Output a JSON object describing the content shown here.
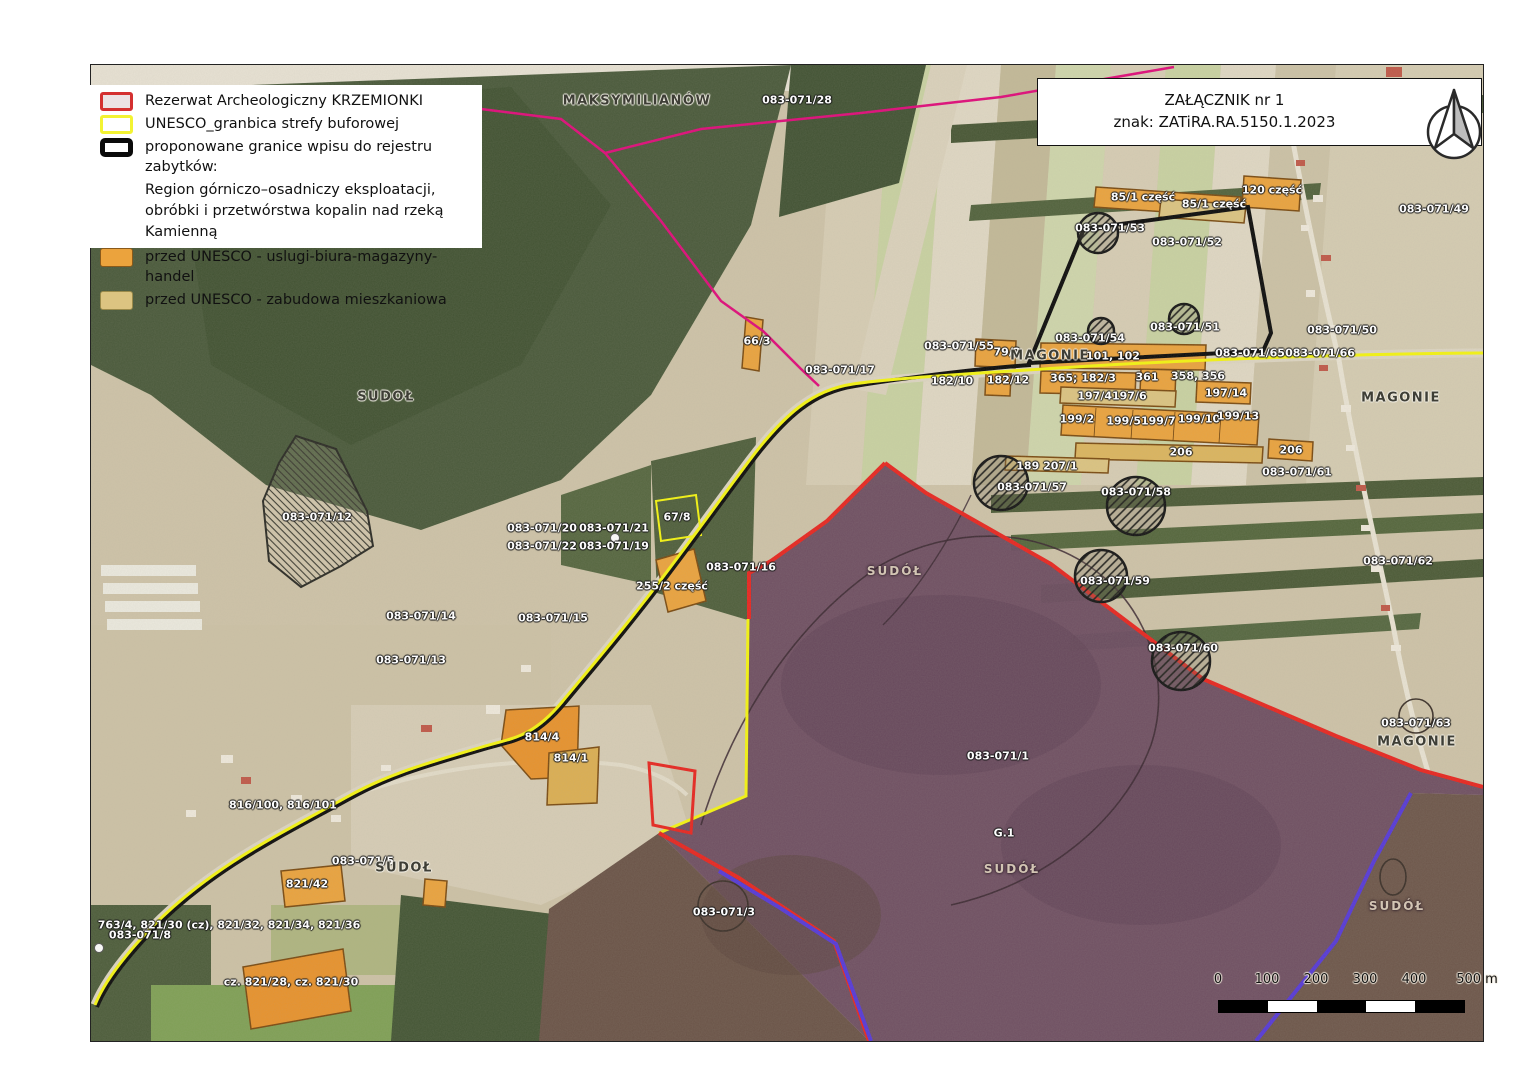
{
  "title_box": {
    "line1": "ZAŁĄCZNIK nr 1",
    "line2": "znak: ZATiRA.RA.5150.1.2023"
  },
  "legend": {
    "items": [
      {
        "label": "Rezerwat Archeologiczny KRZEMIONKI"
      },
      {
        "label": "UNESCO_granbica strefy buforowej"
      },
      {
        "label": "proponowane granice wpisu do rejestru zabytków:",
        "line2": "Region górniczo–osadniczy eksploatacji,",
        "line3": "obróbki i przetwórstwa kopalin nad rzeką Kamienną"
      },
      {
        "label": "przed UNESCO - uslugi-biura-magazyny-handel"
      },
      {
        "label": "przed UNESCO - zabudowa mieszkaniowa"
      }
    ]
  },
  "scale_bar": {
    "ticks": [
      "0",
      "100",
      "200",
      "300",
      "400",
      "500 m"
    ]
  },
  "colors": {
    "reserve_border": "#e8251f",
    "reserve_fill": "#6b4b60",
    "unesco_buffer": "#f5f510",
    "proposed_boundary": "#000000",
    "services_fill": "#eba33d",
    "residential_fill": "#dcc481",
    "admin_boundary_magenta": "#e00a7a",
    "admin_boundary_blue": "#5538d8"
  },
  "icons": {
    "north_arrow": "north-arrow"
  },
  "map_labels": [
    "MAKSYMILIANÓW",
    "083-071/28",
    "85/1 część",
    "85/1 część",
    "120 część",
    "083-071/49",
    "083-071/53",
    "083-071/52",
    "083-071/51",
    "083-071/50",
    "083-071/54",
    "083-071/55",
    "79/2",
    "MAGONIE",
    "101, 102",
    "083-071/65",
    "083-071/66",
    "083-071/17",
    "182/10",
    "182/12",
    "365; 182/3",
    "361",
    "358, 356",
    "197/4197/6",
    "197/14",
    "199/2",
    "199/5199/7",
    "199/10",
    "199/13",
    "MAGONIE",
    "206",
    "206",
    "189 207/1",
    "083-071/57",
    "083-071/58",
    "083-071/61",
    "083-071/62",
    "083-071/59",
    "083-071/60",
    "083-071/63",
    "MAGONIE",
    "SUDOŁ",
    "083-071/12",
    "66/3",
    "67/8",
    "083-071/20",
    "083-071/21",
    "083-071/22",
    "083-071/19",
    "255/2 część",
    "083-071/16",
    "083-071/14",
    "083-071/15",
    "083-071/13",
    "814/4",
    "814/1",
    "816/100, 816/101",
    "083-071/5",
    "SUDOŁ",
    "821/42",
    "763/4, 821/30 (cz), 821/32, 821/34, 821/36",
    "083-071/8",
    "cz. 821/28, cz. 821/30",
    "SUDÓŁ",
    "083-071/1",
    "G.1",
    "SUDÓŁ",
    "083-071/3",
    "SUDÓŁ"
  ]
}
